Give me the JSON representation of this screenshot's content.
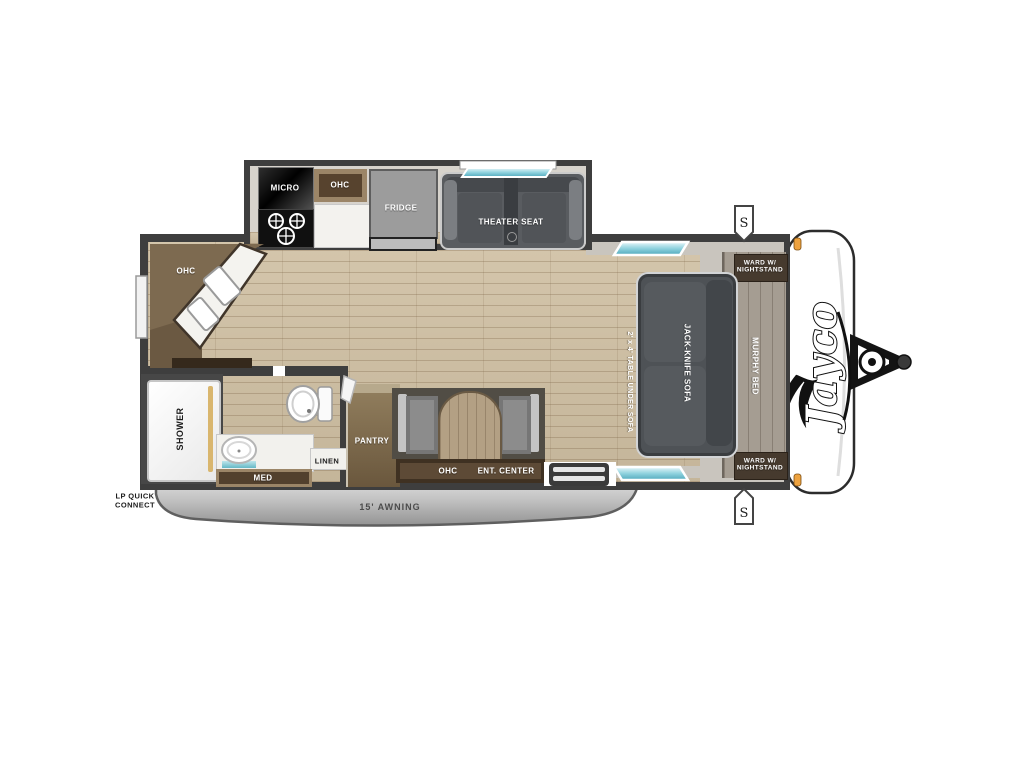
{
  "brand": {
    "logo": "Jayco"
  },
  "slide_out": {
    "micro": "MICRO",
    "ohc": "OHC",
    "fridge": "FRIDGE",
    "theater_seat": "THEATER SEAT"
  },
  "kitchen": {
    "corner_ohc": "OHC"
  },
  "bathroom": {
    "shower": "SHOWER",
    "med": "MED",
    "linen": "LINEN"
  },
  "living": {
    "pantry": "PANTRY",
    "ohc": "OHC",
    "ent_center": "ENT. CENTER",
    "table_note": "2' x 4' TABLE UNDER SOFA",
    "sofa": "JACK-KNIFE SOFA",
    "murphy_bed": "MURPHY BED",
    "ward_front_top": "WARD W/ NIGHTSTAND",
    "ward_front_bottom": "WARD W/ NIGHTSTAND"
  },
  "exterior": {
    "awning": "15' AWNING",
    "lp_quick_connect": "LP QUICK CONNECT",
    "speaker_top": "S",
    "speaker_bottom": "S"
  },
  "colors": {
    "wall": "#3e3e3e",
    "trim": "#c9c5be",
    "wood": "#cfbfa2",
    "cabinet": "#7c6950",
    "window_accent": "#79c4d4"
  }
}
